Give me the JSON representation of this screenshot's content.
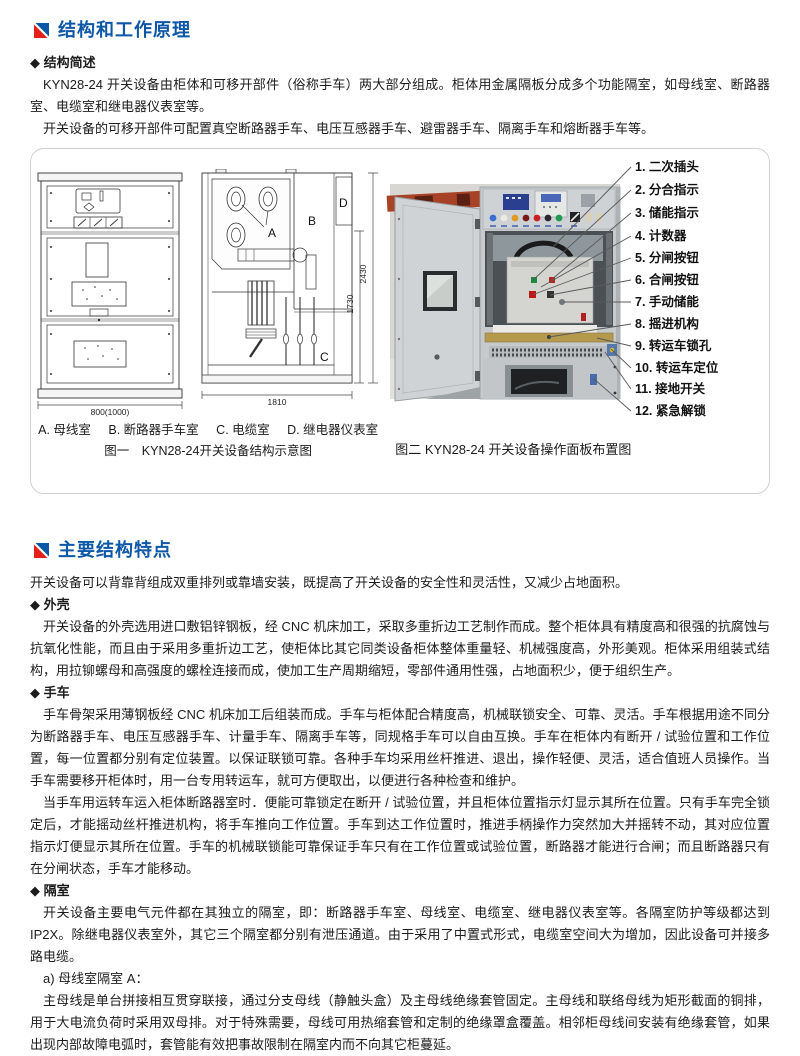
{
  "theme": {
    "accent_blue": "#0d57a7",
    "accent_red": "#e3211a",
    "text_color": "#1c1c1c",
    "figure_border": "#cfcfcf"
  },
  "section1": {
    "title": "结构和工作原理",
    "subheading": "◆ 结构简述",
    "p1": "KYN28-24 开关设备由柜体和可移开部件（俗称手车）两大部分组成。柜体用金属隔板分成多个功能隔室，如母线室、断路器室、电缆室和继电器仪表室等。",
    "p2": "开关设备的可移开部件可配置真空断路器手车、电压互感器手车、避雷器手车、隔离手车和熔断器手车等。"
  },
  "figure1": {
    "compartment_labels": [
      "A",
      "B",
      "C",
      "D"
    ],
    "dims": {
      "front_width": "800(1000)",
      "side_width": "1810",
      "height_outer": "2430",
      "height_inner": "1730"
    },
    "legend": [
      "A. 母线室",
      "B. 断路器手车室",
      "C. 电缆室",
      "D. 继电器仪表室"
    ],
    "caption": "图一　KYN28-24开关设备结构示意图"
  },
  "figure2": {
    "callouts": [
      "1. 二次插头",
      "2. 分合指示",
      "3. 储能指示",
      "4. 计数器",
      "5. 分闸按钮",
      "6. 合闸按钮",
      "7. 手动储能",
      "8. 摇进机构",
      "9. 转运车锁孔",
      "10. 转运车定位",
      "11. 接地开关",
      "12. 紧急解锁"
    ],
    "caption": "图二 KYN28-24 开关设备操作面板布置图"
  },
  "section2": {
    "title": "主要结构特点",
    "intro": "开关设备可以背靠背组成双重排列或靠墙安装，既提高了开关设备的安全性和灵活性，又减少占地面积。",
    "enclosure_heading": "◆ 外壳",
    "enclosure_p": "开关设备的外壳选用进口敷铝锌钢板，经 CNC 机床加工，采取多重折边工艺制作而成。整个柜体具有精度高和很强的抗腐蚀与抗氧化性能，而且由于采用多重折边工艺，使柜体比其它同类设备柜体整体重量轻、机械强度高，外形美观。柜体采用组装式结构，用拉铆螺母和高强度的螺栓连接而成，使加工生产周期缩短，零部件通用性强，占地面积少，便于组织生产。",
    "trolley_heading": "◆ 手车",
    "trolley_p1": "手车骨架采用薄钢板经 CNC 机床加工后组装而成。手车与柜体配合精度高，机械联锁安全、可靠、灵活。手车根据用途不同分为断路器手车、电压互感器手车、计量手车、隔离手车等，同规格手车可以自由互换。手车在柜体内有断开 / 试验位置和工作位置，每一位置都分别有定位装置。以保证联锁可靠。各种手车均采用丝杆推进、退出，操作轻便、灵活，适合值班人员操作。当手车需要移开柜体时，用一台专用转运车，就可方便取出，以便进行各种检查和维护。",
    "trolley_p2": "当手车用运转车运入柜体断路器室时．便能可靠锁定在断开 / 试验位置，并且柜体位置指示灯显示其所在位置。只有手车完全锁定后，才能摇动丝杆推进机构，将手车推向工作位置。手车到达工作位置时，推进手柄操作力突然加大并摇转不动，其对应位置指示灯便显示其所在位置。手车的机械联锁能可靠保证手车只有在工作位置或试验位置，断路器才能进行合闸；而且断路器只有在分闸状态，手车才能移动。",
    "compartment_heading": "◆ 隔室",
    "compartment_p": "开关设备主要电气元件都在其独立的隔室，即：断路器手车室、母线室、电缆室、继电器仪表室等。各隔室防护等级都达到 IP2X。除继电器仪表室外，其它三个隔室都分别有泄压通道。由于采用了中置式形式，电缆室空间大为增加，因此设备可并接多路电缆。",
    "busbar_heading": "a) 母线室隔室 A：",
    "busbar_p": "主母线是单台拼接相互贯穿联接，通过分支母线（静触头盒）及主母线绝缘套管固定。主母线和联络母线为矩形截面的铜排，用于大电流负荷时采用双母排。对于特殊需要，母线可用热缩套管和定制的绝缘罩盒覆盖。相邻柜母线间安装有绝缘套管，如果出现内部故障电弧时，套管能有效把事故限制在隔室内而不向其它柜蔓延。"
  }
}
